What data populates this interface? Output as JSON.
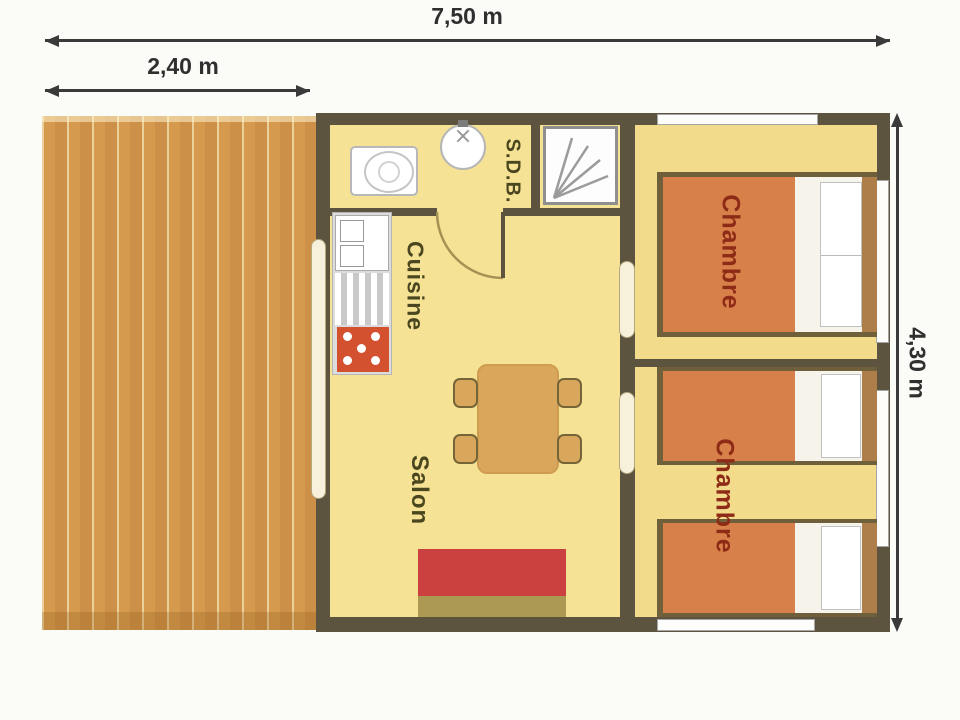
{
  "dimensions": {
    "total_width": "7,50 m",
    "deck_width": "2,40 m",
    "total_height": "4,30 m"
  },
  "rooms": {
    "bathroom": "S.D.B.",
    "kitchen": "Cuisine",
    "living_room": "Salon",
    "bedroom_top": "Chambre",
    "bedroom_bottom": "Chambre"
  },
  "furniture_icons": [
    "deck-planks",
    "toilet",
    "washbasin",
    "shower",
    "kitchen-sink",
    "drainer",
    "stove",
    "dining-table",
    "chair",
    "sofa",
    "double-bed",
    "single-bed",
    "pillow",
    "sliding-door",
    "hinged-door",
    "window"
  ],
  "colors": {
    "wall": "#5d5440",
    "floor_main": "#f6e295",
    "floor_bedroom": "#f2dc8c",
    "deck_plank": "#d59a4e",
    "bed_blanket": "#d8804a",
    "headboard": "#ad7e4a",
    "sofa_red": "#cb4140",
    "sofa_base": "#ac9a54",
    "stove_red": "#d4512f",
    "table_wood": "#d9a75b",
    "room_label": "#4a461f",
    "bedroom_label": "#8d2b16",
    "dimension_text": "#2f2f2f"
  }
}
